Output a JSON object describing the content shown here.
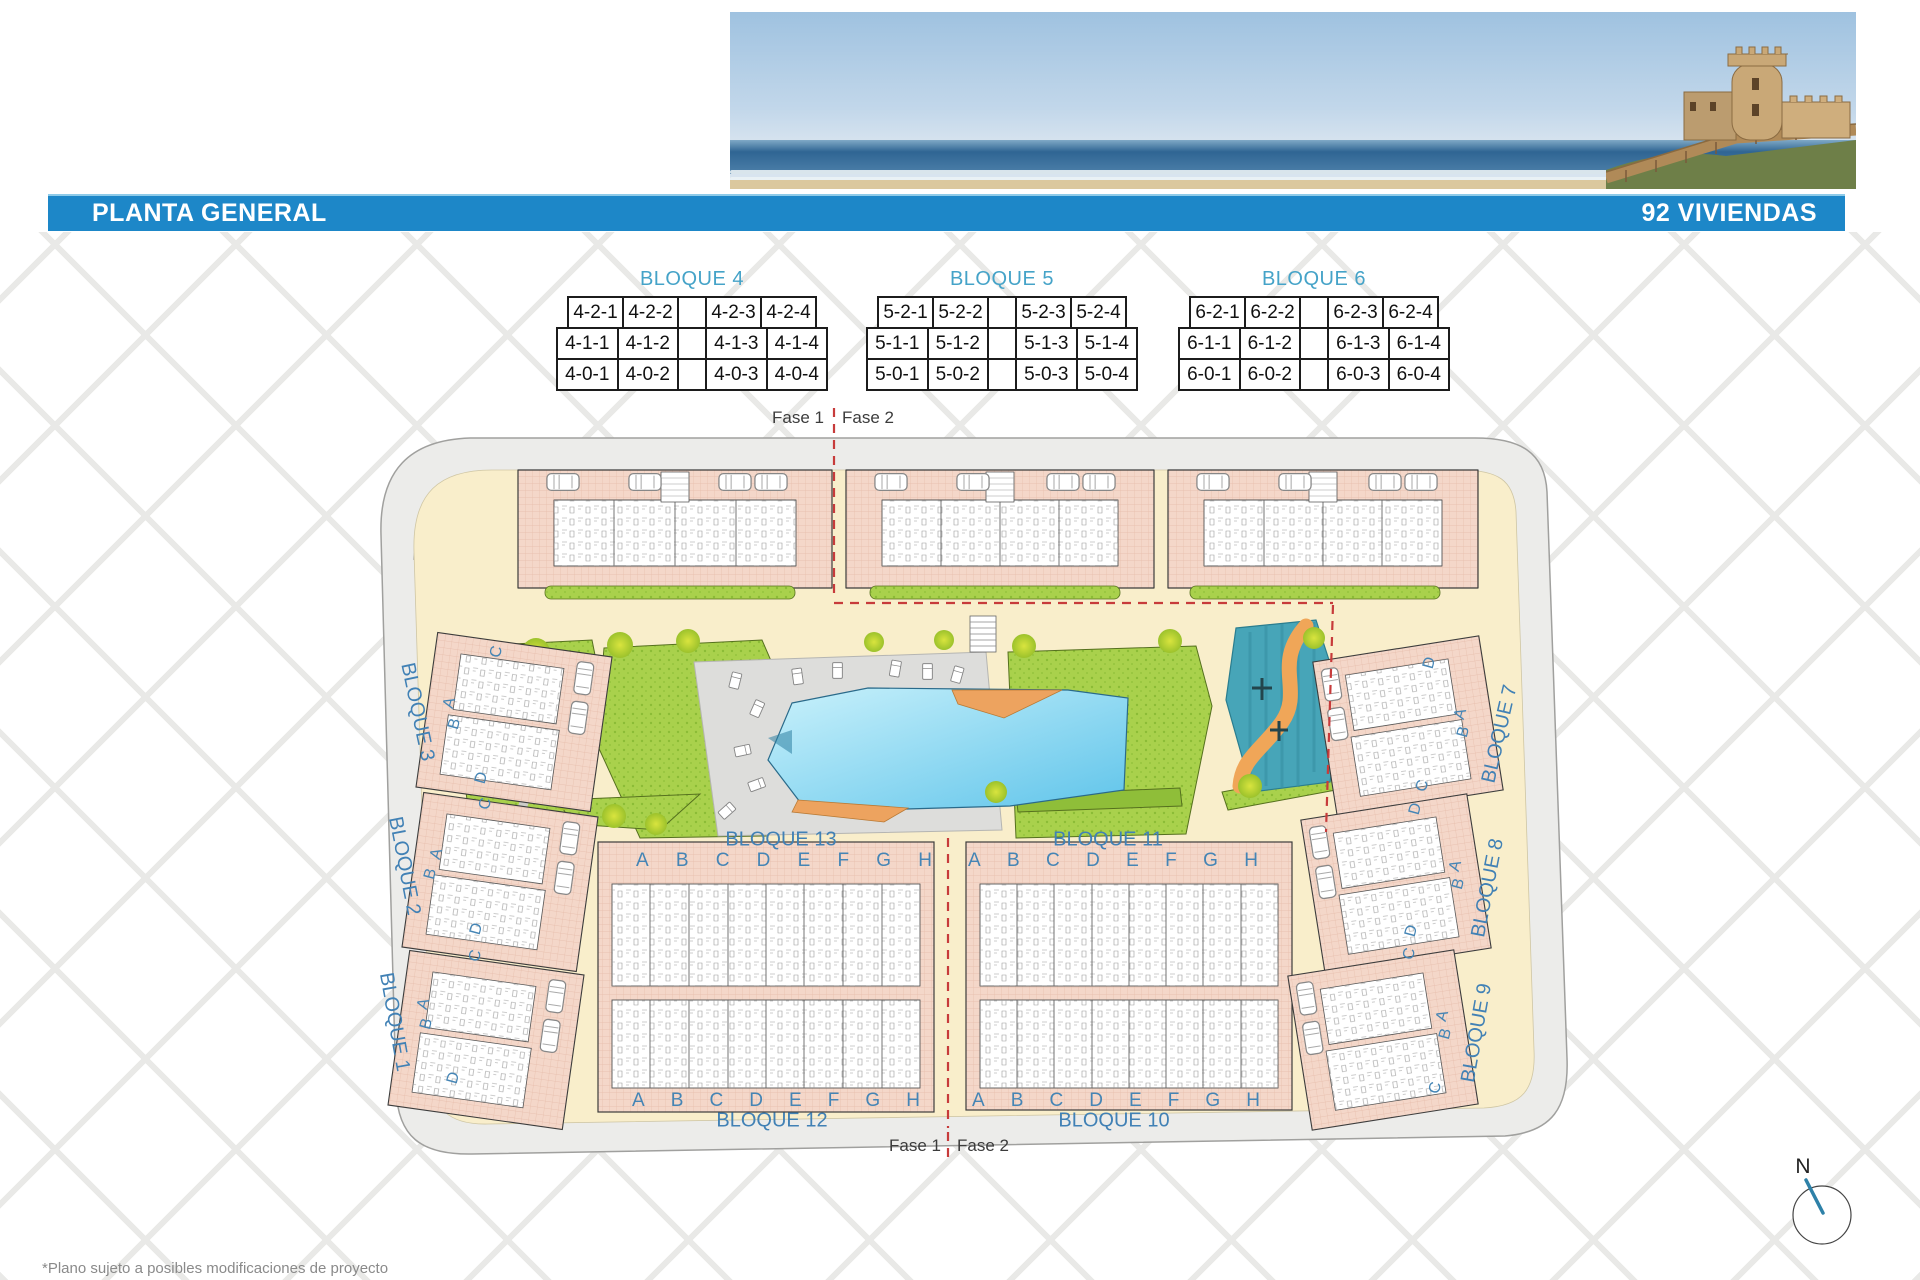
{
  "header": {
    "title": "PLANTA GENERAL",
    "units_label": "92 VIVIENDAS"
  },
  "tables": [
    {
      "title": "BLOQUE 4",
      "rows": [
        [
          "4-2-1",
          "4-2-2",
          "",
          "4-2-3",
          "4-2-4"
        ],
        [
          "4-1-1",
          "4-1-2",
          "",
          "4-1-3",
          "4-1-4"
        ],
        [
          "4-0-1",
          "4-0-2",
          "",
          "4-0-3",
          "4-0-4"
        ]
      ]
    },
    {
      "title": "BLOQUE 5",
      "rows": [
        [
          "5-2-1",
          "5-2-2",
          "",
          "5-2-3",
          "5-2-4"
        ],
        [
          "5-1-1",
          "5-1-2",
          "",
          "5-1-3",
          "5-1-4"
        ],
        [
          "5-0-1",
          "5-0-2",
          "",
          "5-0-3",
          "5-0-4"
        ]
      ]
    },
    {
      "title": "BLOQUE 6",
      "rows": [
        [
          "6-2-1",
          "6-2-2",
          "",
          "6-2-3",
          "6-2-4"
        ],
        [
          "6-1-1",
          "6-1-2",
          "",
          "6-1-3",
          "6-1-4"
        ],
        [
          "6-0-1",
          "6-0-2",
          "",
          "6-0-3",
          "6-0-4"
        ]
      ]
    }
  ],
  "plan": {
    "phase": {
      "f1": "Fase 1",
      "f2": "Fase 2"
    },
    "blocks": {
      "b13": "BLOQUE 13",
      "b11": "BLOQUE 11",
      "b12": "BLOQUE 12",
      "b10": "BLOQUE 10",
      "b3": "BLOQUE 3",
      "b2": "BLOQUE 2",
      "b1": "BLOQUE 1",
      "b7": "BLOQUE 7",
      "b8": "BLOQUE 8",
      "b9": "BLOQUE 9"
    },
    "unit_letters": [
      "A",
      "B",
      "C",
      "D",
      "E",
      "F",
      "G",
      "H"
    ],
    "side_left": [
      [
        "C",
        "A",
        "B",
        "D",
        "C"
      ],
      [
        "A",
        "B",
        "D",
        "C"
      ],
      [
        "A",
        "B",
        "D"
      ]
    ],
    "side_right": [
      [
        "D",
        "A",
        "B",
        "C",
        "D"
      ],
      [
        "A",
        "B",
        "D",
        "C"
      ],
      [
        "A",
        "B",
        "C"
      ]
    ]
  },
  "compass": {
    "north_label": "N"
  },
  "footnote": "*Plano sujeto a posibles modificaciones de proyecto",
  "colors": {
    "bar_blue": "#1d87c8",
    "label_blue": "#4585b5",
    "table_title_blue": "#45a3c8",
    "building_salmon": "#f4d7c9",
    "garden_green": "#a9d14c",
    "pool_blue": "#6cc9ec",
    "deck_orange": "#eda35f",
    "splash_teal": "#47a5b8",
    "phase_red": "#c73b3b",
    "road_grey": "#ececea",
    "path_beige": "#f9eecb"
  }
}
